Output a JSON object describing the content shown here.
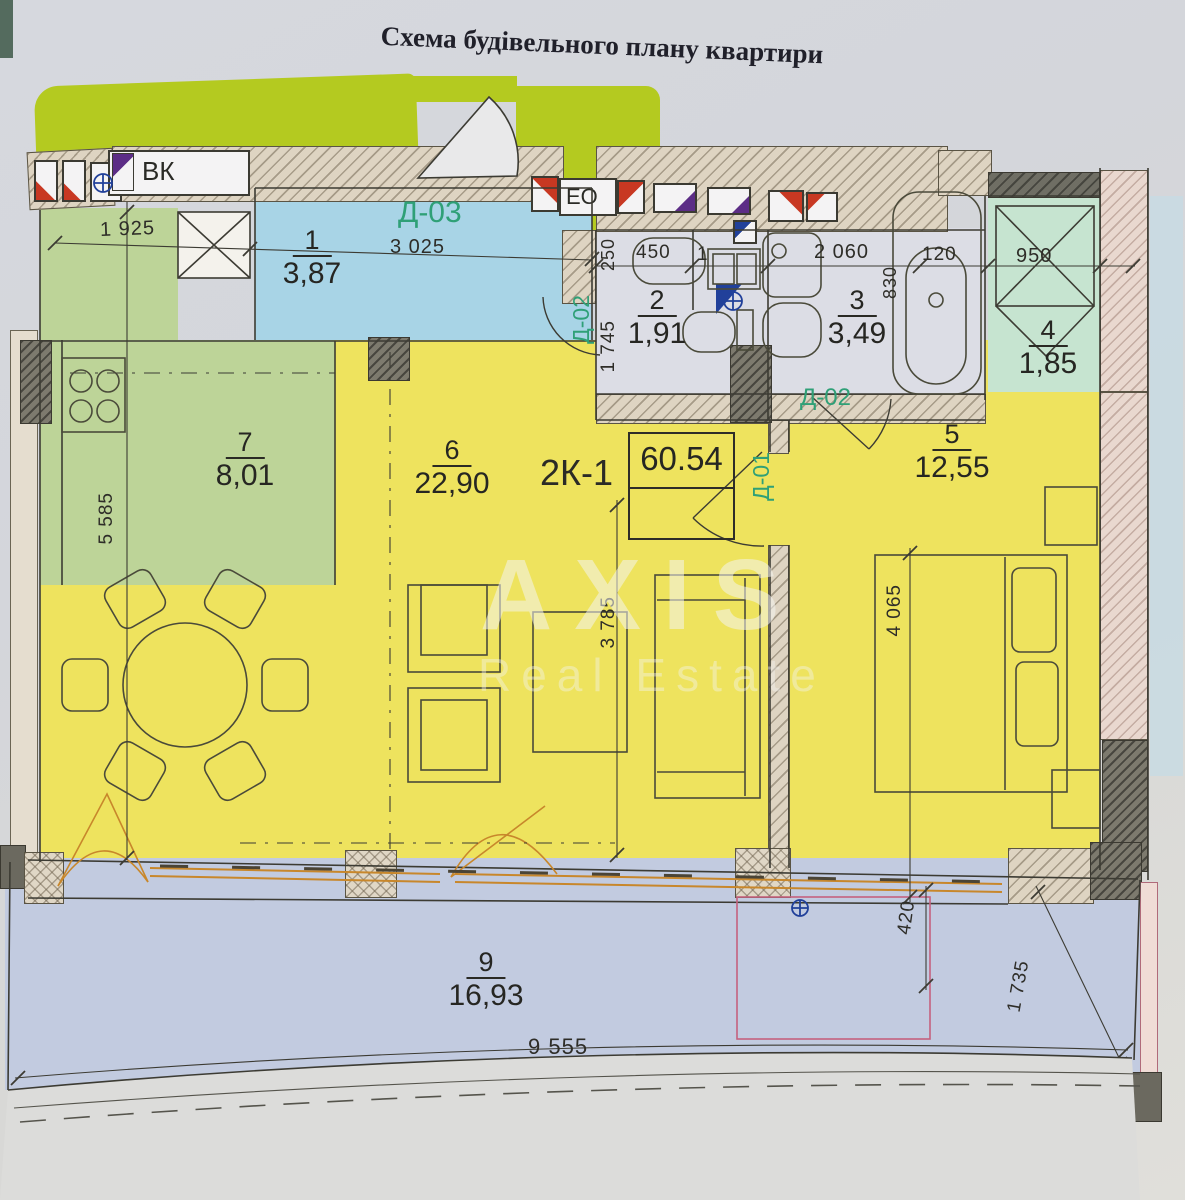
{
  "title": "Схема будівельного плану квартири",
  "watermark": {
    "line1": "AXIS",
    "line2": "Real Estate"
  },
  "plan": {
    "unit_label": "2К-1",
    "total_area": "60.54",
    "rooms": [
      {
        "n": "1",
        "a": "3,87"
      },
      {
        "n": "2",
        "a": "1,91"
      },
      {
        "n": "3",
        "a": "3,49"
      },
      {
        "n": "4",
        "a": "1,85"
      },
      {
        "n": "5",
        "a": "12,55"
      },
      {
        "n": "6",
        "a": "22,90"
      },
      {
        "n": "7",
        "a": "8,01"
      },
      {
        "n": "9",
        "a": "16,93"
      }
    ],
    "markers": {
      "vk": "ВК",
      "eo": "ЕО",
      "d03": "Д-03",
      "d02_left": "Д-02",
      "d02_right": "Д-02",
      "d01": "Д-01"
    },
    "dimensions": {
      "w1925": "1 925",
      "w3025": "3 025",
      "w450": "450",
      "partial1": "1",
      "w2060": "2 060",
      "w120": "120",
      "w950": "950",
      "v250": "250",
      "v1745": "1 745",
      "v830": "830",
      "v5585": "5 585",
      "v3785": "3 785",
      "v4065": "4 065",
      "v420": "420",
      "v1735": "1 735",
      "w9555": "9 555"
    }
  },
  "colors": {
    "lime_band": "#b4ca20",
    "hall_blue": "#a8d4e6",
    "room_yellow": "#eee35e",
    "kitchen_green": "#bdd498",
    "mint": "#c6e4d0",
    "balcony_blue": "#c2cbe0",
    "marker_green": "#2fa077",
    "flag_red": "#c83822",
    "flag_blue": "#21409a",
    "flag_purple": "#5c2d86",
    "window_orange": "#c8872b",
    "pink_line": "#c4627e"
  }
}
